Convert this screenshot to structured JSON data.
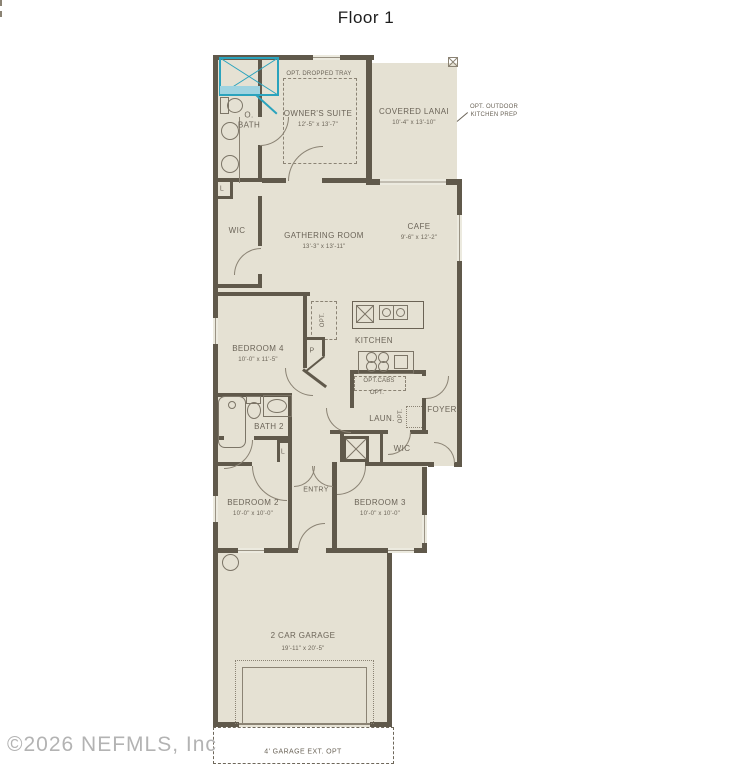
{
  "title": "Floor 1",
  "watermark": "©2026 NEFMLS, Inc",
  "colors": {
    "wall": "#60594b",
    "room_fill": "#e5e1d3",
    "teal_accent": "#2aa3bd",
    "label_text": "#6b6458",
    "watermark_text": "#b3b3b3"
  },
  "rooms": {
    "owners_suite": {
      "label": "OWNER'S SUITE",
      "dims": "12'-5\" x 13'-7\""
    },
    "covered_lanai": {
      "label": "COVERED LANAI",
      "dims": "10'-4\" x 13'-10\""
    },
    "o_bath": {
      "label": "O.\nBATH"
    },
    "wic_owner": {
      "label": "WIC"
    },
    "gathering": {
      "label": "GATHERING ROOM",
      "dims": "13'-3\" x 13'-11\""
    },
    "cafe": {
      "label": "CAFE",
      "dims": "9'-6\" x 12'-2\""
    },
    "kitchen": {
      "label": "KITCHEN"
    },
    "bedroom4": {
      "label": "BEDROOM 4",
      "dims": "10'-0\" x 11'-5\""
    },
    "bath2": {
      "label": "BATH 2"
    },
    "laundry": {
      "label": "LAUN."
    },
    "foyer": {
      "label": "FOYER"
    },
    "wic_bed3": {
      "label": "WIC"
    },
    "entry": {
      "label": "ENTRY"
    },
    "bedroom2": {
      "label": "BEDROOM 2",
      "dims": "10'-0\" x 10'-0\""
    },
    "bedroom3": {
      "label": "BEDROOM 3",
      "dims": "10'-0\" x 10'-0\""
    },
    "garage": {
      "label": "2 CAR GARAGE",
      "dims": "19'-11\" x 20'-5\""
    }
  },
  "annotations": {
    "dropped_tray": "OPT. DROPPED TRAY",
    "outdoor_kitchen": "OPT. OUTDOOR\nKITCHEN PREP",
    "opt_cabs": "OPT.CABS",
    "opt_cabs2": "OPT.",
    "opt_pantry": "OPT.",
    "opt_laundry": "OPT.",
    "pantry": "P",
    "linen_owner": "L",
    "linen_hall": "L",
    "garage_ext": "4' GARAGE EXT. OPT"
  }
}
